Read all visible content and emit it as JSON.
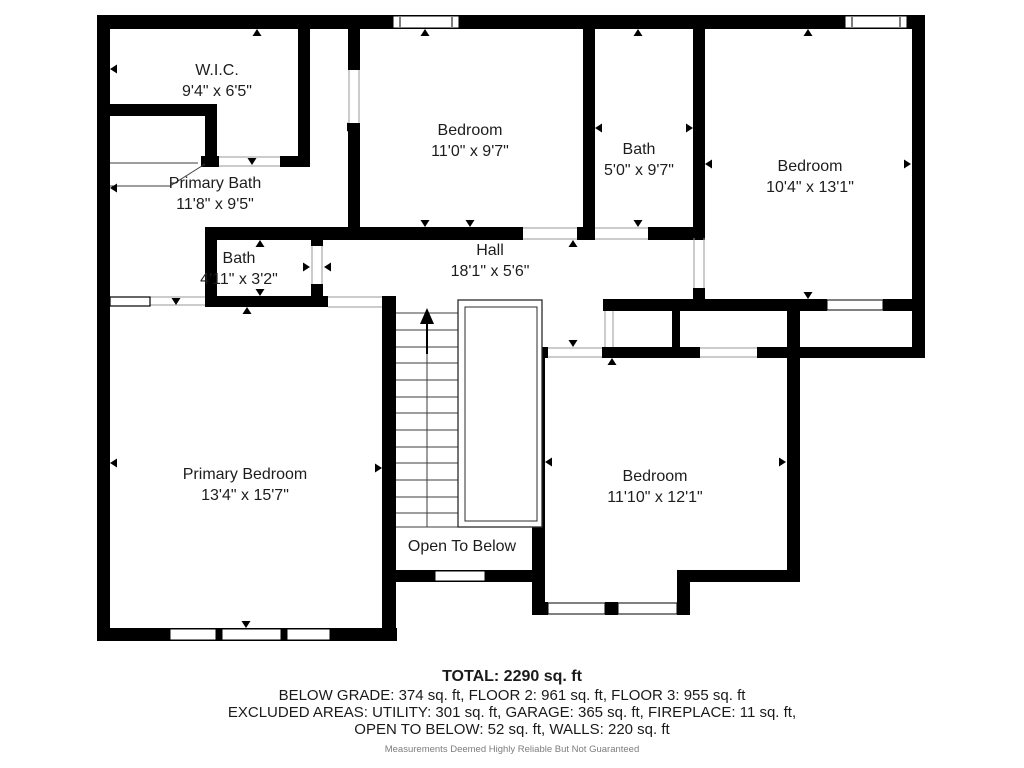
{
  "rooms": [
    {
      "name": "W.I.C.",
      "dims": "9'4\" x 6'5\""
    },
    {
      "name": "Bedroom",
      "dims": "11'0\" x 9'7\""
    },
    {
      "name": "Bath",
      "dims": "5'0\" x 9'7\""
    },
    {
      "name": "Bedroom",
      "dims": "10'4\" x 13'1\""
    },
    {
      "name": "Primary Bath",
      "dims": "11'8\" x 9'5\""
    },
    {
      "name": "Bath",
      "dims": "4'11\" x 3'2\""
    },
    {
      "name": "Hall",
      "dims": "18'1\" x 5'6\""
    },
    {
      "name": "Primary Bedroom",
      "dims": "13'4\" x 15'7\""
    },
    {
      "name": "Bedroom",
      "dims": "11'10\" x 12'1\""
    },
    {
      "name": "Open To Below",
      "dims": ""
    }
  ],
  "summary": {
    "total": "TOTAL: 2290 sq. ft",
    "line1": "BELOW GRADE: 374 sq. ft, FLOOR 2: 961 sq. ft, FLOOR 3: 955 sq. ft",
    "line2": "EXCLUDED AREAS: UTILITY: 301 sq. ft, GARAGE: 365 sq. ft, FIREPLACE: 11 sq. ft,",
    "line3": "OPEN TO BELOW: 52 sq. ft, WALLS: 220 sq. ft",
    "disclaimer": "Measurements Deemed Highly Reliable But Not Guaranteed"
  },
  "colors": {
    "wall": "#000000",
    "background": "#ffffff",
    "text": "#1d1d1d"
  }
}
